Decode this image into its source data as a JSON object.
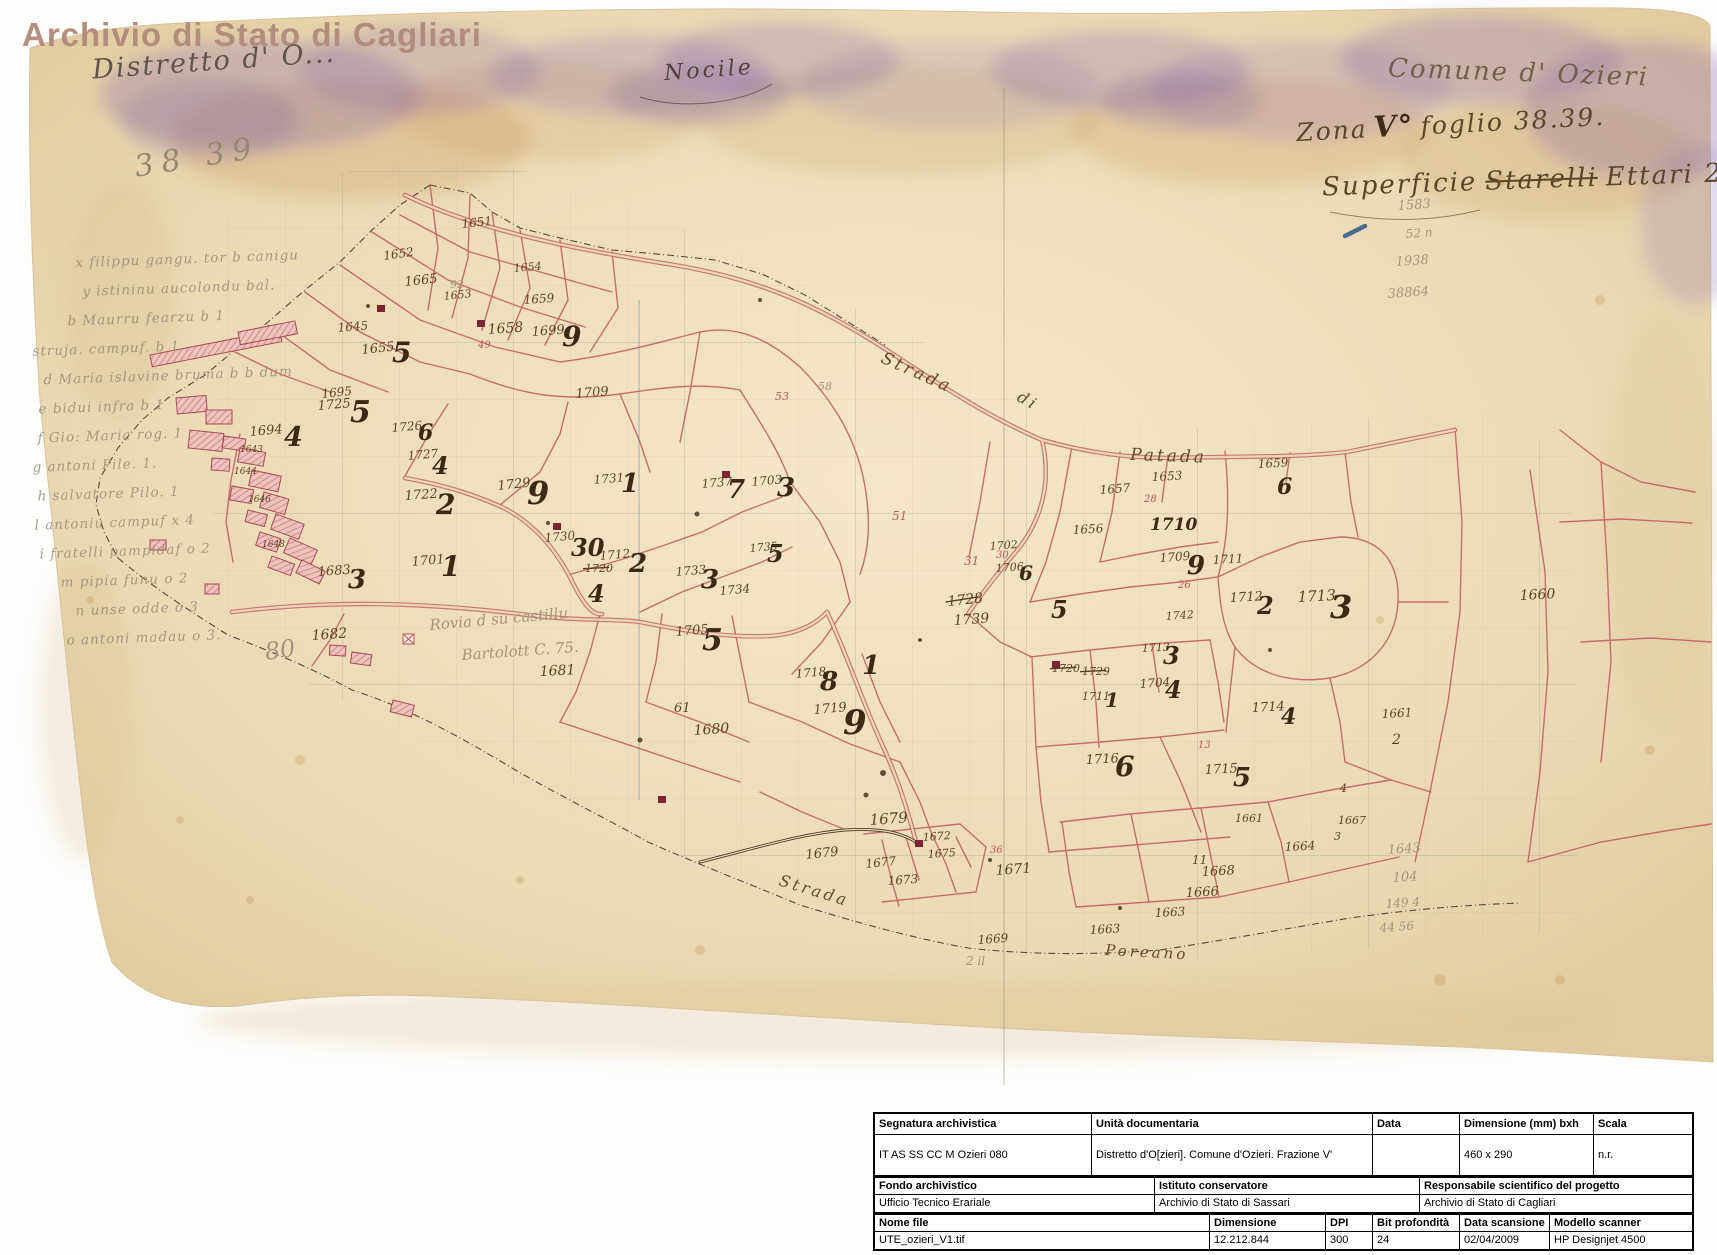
{
  "watermark": "Archivio di Stato di Cagliari",
  "annotations": {
    "distretto": "Distretto d' O...",
    "sheet_pencil": "38 39",
    "center_name": "Nocile",
    "comune": "Comune d' Ozieri",
    "zona_pre": "Zona",
    "zona_v": "V°",
    "zona_post": "foglio 38.39.",
    "superficie_prefix": "Superficie",
    "superficie_struck": "Starelli",
    "superficie_suffix": "Ettari 296,04"
  },
  "margin_notes": [
    {
      "t": "x filippu gangu. tor b canigu",
      "dx": 52
    },
    {
      "t": "y istininu aucolondu bal.",
      "dx": 58
    },
    {
      "t": "b Maurru fearzu b 1",
      "dx": 42
    },
    {
      "t": "struja. campuf. b 1",
      "dx": 6
    },
    {
      "t": "d Maria islavine bruma b b dum",
      "dx": 16
    },
    {
      "t": "e bidui infra b 1",
      "dx": 10
    },
    {
      "t": "f Gio: Maria rog. 1",
      "dx": 8
    },
    {
      "t": "g antoni Pile. 1.",
      "dx": 2
    },
    {
      "t": "h salvatore Pilo. 1",
      "dx": 6
    },
    {
      "t": "l antoniu campuf x 4",
      "dx": 2
    },
    {
      "t": "i fratelli pampidaf o 2",
      "dx": 6
    },
    {
      "t": "m pipia funu o 2",
      "dx": 26
    },
    {
      "t": "n unse odde o 3",
      "dx": 40
    },
    {
      "t": "o antoni madau o 3.",
      "dx": 30
    }
  ],
  "road_labels": [
    {
      "t": "Strada",
      "x": 880,
      "y": 362,
      "s": 17,
      "r": 24
    },
    {
      "t": "di",
      "x": 1016,
      "y": 400,
      "s": 16,
      "r": 30
    },
    {
      "t": "Patada",
      "x": 1130,
      "y": 460,
      "s": 17,
      "r": 2
    },
    {
      "t": "Strada",
      "x": 778,
      "y": 885,
      "s": 16,
      "r": 17
    },
    {
      "t": "Poreano",
      "x": 1105,
      "y": 955,
      "s": 15,
      "r": 3
    }
  ],
  "pencil_scribbles": [
    {
      "t": "Rovia d su castillu",
      "x": 430,
      "y": 630,
      "s": 15,
      "r": -5
    },
    {
      "t": "Bartolott  C. 75.",
      "x": 462,
      "y": 660,
      "s": 15,
      "r": -4
    }
  ],
  "parcel_labels": [
    {
      "t": "1651",
      "x": 462,
      "y": 228,
      "s": 12,
      "c": "i",
      "r": -6
    },
    {
      "t": "1652",
      "x": 384,
      "y": 260,
      "s": 12,
      "c": "i",
      "r": -8
    },
    {
      "t": "1654",
      "x": 514,
      "y": 272,
      "s": 11,
      "c": "i",
      "r": -5
    },
    {
      "t": "1659",
      "x": 524,
      "y": 304,
      "s": 12,
      "c": "i",
      "r": -4
    },
    {
      "t": "1665",
      "x": 405,
      "y": 286,
      "s": 13,
      "c": "i",
      "r": -6
    },
    {
      "t": "92",
      "x": 450,
      "y": 288,
      "s": 11,
      "c": "p"
    },
    {
      "t": "1653",
      "x": 444,
      "y": 300,
      "s": 11,
      "c": "i",
      "r": -6
    },
    {
      "t": "1645",
      "x": 338,
      "y": 332,
      "s": 12,
      "c": "i",
      "r": -5
    },
    {
      "t": "1658",
      "x": 488,
      "y": 334,
      "s": 14,
      "c": "i",
      "r": -4
    },
    {
      "t": "49",
      "x": 478,
      "y": 348,
      "s": 10,
      "c": "r"
    },
    {
      "t": "1699",
      "x": 532,
      "y": 336,
      "s": 13,
      "c": "i",
      "r": -4
    },
    {
      "t": "9",
      "x": 562,
      "y": 346,
      "s": 28,
      "c": "b"
    },
    {
      "t": "1655",
      "x": 362,
      "y": 354,
      "s": 13,
      "c": "i",
      "r": -6
    },
    {
      "t": "5",
      "x": 392,
      "y": 362,
      "s": 28,
      "c": "b"
    },
    {
      "t": "1709",
      "x": 576,
      "y": 398,
      "s": 13,
      "c": "i",
      "r": -5
    },
    {
      "t": "1695",
      "x": 322,
      "y": 398,
      "s": 12,
      "c": "i",
      "r": -6
    },
    {
      "t": "1694",
      "x": 250,
      "y": 436,
      "s": 13,
      "c": "i",
      "r": -5
    },
    {
      "t": "4",
      "x": 284,
      "y": 446,
      "s": 27,
      "c": "b"
    },
    {
      "t": "1725",
      "x": 318,
      "y": 410,
      "s": 13,
      "c": "i",
      "r": -5
    },
    {
      "t": "5",
      "x": 350,
      "y": 422,
      "s": 30,
      "c": "b"
    },
    {
      "t": "1726",
      "x": 392,
      "y": 432,
      "s": 12,
      "c": "i",
      "r": -5
    },
    {
      "t": "6",
      "x": 418,
      "y": 440,
      "s": 22,
      "c": "b"
    },
    {
      "t": "1727",
      "x": 408,
      "y": 460,
      "s": 12,
      "c": "i",
      "r": -5
    },
    {
      "t": "4",
      "x": 432,
      "y": 474,
      "s": 24,
      "c": "b"
    },
    {
      "t": "1722",
      "x": 405,
      "y": 500,
      "s": 13,
      "c": "i",
      "r": -4
    },
    {
      "t": "2",
      "x": 436,
      "y": 514,
      "s": 28,
      "c": "b"
    },
    {
      "t": "1729",
      "x": 498,
      "y": 490,
      "s": 13,
      "c": "i",
      "r": -6
    },
    {
      "t": "9",
      "x": 527,
      "y": 504,
      "s": 32,
      "c": "b"
    },
    {
      "t": "1731",
      "x": 594,
      "y": 484,
      "s": 12,
      "c": "i",
      "r": -5
    },
    {
      "t": "1",
      "x": 621,
      "y": 492,
      "s": 26,
      "c": "b"
    },
    {
      "t": "1737",
      "x": 702,
      "y": 488,
      "s": 12,
      "c": "i",
      "r": -5
    },
    {
      "t": "7",
      "x": 727,
      "y": 498,
      "s": 26,
      "c": "b"
    },
    {
      "t": "1703",
      "x": 752,
      "y": 486,
      "s": 12,
      "c": "i",
      "r": -5
    },
    {
      "t": "3",
      "x": 777,
      "y": 496,
      "s": 26,
      "c": "b"
    },
    {
      "t": "1730",
      "x": 545,
      "y": 542,
      "s": 12,
      "c": "i",
      "r": -5
    },
    {
      "t": "30",
      "x": 571,
      "y": 556,
      "s": 24,
      "c": "b"
    },
    {
      "t": "1712",
      "x": 600,
      "y": 560,
      "s": 12,
      "c": "i",
      "r": -5
    },
    {
      "t": "2",
      "x": 629,
      "y": 572,
      "s": 26,
      "c": "b"
    },
    {
      "t": "1701",
      "x": 412,
      "y": 566,
      "s": 13,
      "c": "i",
      "r": -5
    },
    {
      "t": "1",
      "x": 441,
      "y": 576,
      "s": 28,
      "c": "b"
    },
    {
      "t": "1720",
      "x": 585,
      "y": 572,
      "s": 11,
      "c": "i",
      "k": 1
    },
    {
      "t": "1733",
      "x": 676,
      "y": 576,
      "s": 12,
      "c": "i",
      "r": -5
    },
    {
      "t": "3",
      "x": 701,
      "y": 588,
      "s": 26,
      "c": "b"
    },
    {
      "t": "1734",
      "x": 720,
      "y": 595,
      "s": 12,
      "c": "i",
      "r": -5
    },
    {
      "t": "1735",
      "x": 750,
      "y": 552,
      "s": 11,
      "c": "i",
      "r": -5
    },
    {
      "t": "5",
      "x": 767,
      "y": 562,
      "s": 24,
      "c": "b"
    },
    {
      "t": "1683",
      "x": 318,
      "y": 576,
      "s": 13,
      "c": "i",
      "r": -4
    },
    {
      "t": "3",
      "x": 348,
      "y": 588,
      "s": 26,
      "c": "b"
    },
    {
      "t": "1682",
      "x": 312,
      "y": 640,
      "s": 14,
      "c": "i",
      "r": -4
    },
    {
      "t": "80",
      "x": 266,
      "y": 660,
      "s": 24,
      "c": "p",
      "r": -8
    },
    {
      "t": "1681",
      "x": 540,
      "y": 676,
      "s": 14,
      "c": "i",
      "r": -3
    },
    {
      "t": "4",
      "x": 588,
      "y": 602,
      "s": 24,
      "c": "b"
    },
    {
      "t": "1705",
      "x": 676,
      "y": 636,
      "s": 13,
      "c": "i",
      "r": -5
    },
    {
      "t": "5",
      "x": 702,
      "y": 650,
      "s": 30,
      "c": "b"
    },
    {
      "t": "61",
      "x": 674,
      "y": 712,
      "s": 13,
      "c": "i"
    },
    {
      "t": "1680",
      "x": 694,
      "y": 735,
      "s": 14,
      "c": "i",
      "r": -4
    },
    {
      "t": "1718",
      "x": 796,
      "y": 678,
      "s": 12,
      "c": "i",
      "r": -5
    },
    {
      "t": "8",
      "x": 820,
      "y": 690,
      "s": 26,
      "c": "b"
    },
    {
      "t": "1719",
      "x": 814,
      "y": 714,
      "s": 13,
      "c": "i",
      "r": -5
    },
    {
      "t": "9",
      "x": 843,
      "y": 734,
      "s": 34,
      "c": "b"
    },
    {
      "t": "1",
      "x": 862,
      "y": 674,
      "s": 26,
      "c": "b"
    },
    {
      "t": "1643",
      "x": 240,
      "y": 452,
      "s": 9,
      "c": "i"
    },
    {
      "t": "1644",
      "x": 234,
      "y": 474,
      "s": 9,
      "c": "i"
    },
    {
      "t": "1646",
      "x": 248,
      "y": 502,
      "s": 9,
      "c": "i"
    },
    {
      "t": "1648",
      "x": 262,
      "y": 547,
      "s": 9,
      "c": "i"
    },
    {
      "t": "53",
      "x": 775,
      "y": 400,
      "s": 11,
      "c": "r"
    },
    {
      "t": "58",
      "x": 818,
      "y": 390,
      "s": 11,
      "c": "p"
    },
    {
      "t": "51",
      "x": 892,
      "y": 520,
      "s": 12,
      "c": "r"
    },
    {
      "t": "31",
      "x": 964,
      "y": 565,
      "s": 12,
      "c": "r"
    },
    {
      "t": "1728",
      "x": 948,
      "y": 606,
      "s": 14,
      "c": "i",
      "k": 1,
      "r": -6
    },
    {
      "t": "1739",
      "x": 954,
      "y": 625,
      "s": 14,
      "c": "i",
      "r": -4
    },
    {
      "t": "1679",
      "x": 870,
      "y": 825,
      "s": 15,
      "c": "i",
      "r": -4
    },
    {
      "t": "1679",
      "x": 806,
      "y": 859,
      "s": 13,
      "c": "i",
      "r": -6
    },
    {
      "t": "1677",
      "x": 866,
      "y": 868,
      "s": 12,
      "c": "i",
      "r": -6
    },
    {
      "t": "1673",
      "x": 888,
      "y": 885,
      "s": 12,
      "c": "i",
      "r": -4
    },
    {
      "t": "1675",
      "x": 928,
      "y": 858,
      "s": 11,
      "c": "i",
      "r": -4
    },
    {
      "t": "1672",
      "x": 923,
      "y": 841,
      "s": 11,
      "c": "i",
      "r": -4
    },
    {
      "t": "1671",
      "x": 996,
      "y": 875,
      "s": 14,
      "c": "i",
      "r": -4
    },
    {
      "t": "36",
      "x": 990,
      "y": 853,
      "s": 10,
      "c": "r"
    },
    {
      "t": "1669",
      "x": 978,
      "y": 944,
      "s": 12,
      "c": "i",
      "r": -4
    },
    {
      "t": "2 il",
      "x": 966,
      "y": 965,
      "s": 12,
      "c": "p"
    },
    {
      "t": "1653",
      "x": 1152,
      "y": 481,
      "s": 12,
      "c": "i",
      "r": -3
    },
    {
      "t": "1657",
      "x": 1100,
      "y": 494,
      "s": 12,
      "c": "i",
      "r": -4
    },
    {
      "t": "28",
      "x": 1144,
      "y": 502,
      "s": 10,
      "c": "r"
    },
    {
      "t": "1656",
      "x": 1073,
      "y": 534,
      "s": 12,
      "c": "i",
      "r": -3
    },
    {
      "t": "30",
      "x": 996,
      "y": 558,
      "s": 10,
      "c": "r"
    },
    {
      "t": "1659",
      "x": 1258,
      "y": 468,
      "s": 12,
      "c": "i",
      "r": -3
    },
    {
      "t": "6",
      "x": 1277,
      "y": 494,
      "s": 22,
      "c": "b"
    },
    {
      "t": "1710",
      "x": 1150,
      "y": 530,
      "s": 17,
      "c": "b"
    },
    {
      "t": "1709",
      "x": 1160,
      "y": 562,
      "s": 12,
      "c": "i",
      "r": -4
    },
    {
      "t": "9",
      "x": 1187,
      "y": 574,
      "s": 26,
      "c": "b"
    },
    {
      "t": "26",
      "x": 1178,
      "y": 588,
      "s": 10,
      "c": "r"
    },
    {
      "t": "1702",
      "x": 990,
      "y": 550,
      "s": 11,
      "c": "i",
      "r": -4
    },
    {
      "t": "1706",
      "x": 996,
      "y": 572,
      "s": 11,
      "c": "i",
      "r": -4
    },
    {
      "t": "6",
      "x": 1019,
      "y": 580,
      "s": 20,
      "c": "b"
    },
    {
      "t": "5",
      "x": 1051,
      "y": 618,
      "s": 24,
      "c": "b"
    },
    {
      "t": "1711",
      "x": 1213,
      "y": 564,
      "s": 12,
      "c": "i",
      "r": -3
    },
    {
      "t": "1712",
      "x": 1230,
      "y": 602,
      "s": 13,
      "c": "i",
      "r": -3
    },
    {
      "t": "2",
      "x": 1257,
      "y": 614,
      "s": 24,
      "c": "b"
    },
    {
      "t": "1713",
      "x": 1298,
      "y": 602,
      "s": 15,
      "c": "i",
      "r": -3
    },
    {
      "t": "3",
      "x": 1330,
      "y": 618,
      "s": 32,
      "c": "b"
    },
    {
      "t": "1660",
      "x": 1520,
      "y": 600,
      "s": 14,
      "c": "i",
      "r": -3
    },
    {
      "t": "1742",
      "x": 1166,
      "y": 620,
      "s": 11,
      "c": "i",
      "r": -4
    },
    {
      "t": "1713",
      "x": 1142,
      "y": 652,
      "s": 11,
      "c": "i",
      "r": -3
    },
    {
      "t": "3",
      "x": 1163,
      "y": 664,
      "s": 24,
      "c": "b"
    },
    {
      "t": "1704",
      "x": 1140,
      "y": 688,
      "s": 12,
      "c": "i",
      "r": -4
    },
    {
      "t": "4",
      "x": 1165,
      "y": 698,
      "s": 24,
      "c": "b"
    },
    {
      "t": "1714",
      "x": 1252,
      "y": 712,
      "s": 13,
      "c": "i",
      "r": -3
    },
    {
      "t": "4",
      "x": 1281,
      "y": 724,
      "s": 22,
      "c": "b"
    },
    {
      "t": "1720",
      "x": 1052,
      "y": 672,
      "s": 11,
      "c": "i",
      "k": 1
    },
    {
      "t": "1729",
      "x": 1082,
      "y": 675,
      "s": 11,
      "c": "i",
      "k": 1
    },
    {
      "t": "1711",
      "x": 1082,
      "y": 700,
      "s": 11,
      "c": "i"
    },
    {
      "t": "1",
      "x": 1105,
      "y": 707,
      "s": 20,
      "c": "b"
    },
    {
      "t": "1716",
      "x": 1086,
      "y": 764,
      "s": 13,
      "c": "i",
      "r": -3
    },
    {
      "t": "6",
      "x": 1115,
      "y": 776,
      "s": 28,
      "c": "b"
    },
    {
      "t": "1715",
      "x": 1205,
      "y": 774,
      "s": 13,
      "c": "i",
      "r": -3
    },
    {
      "t": "5",
      "x": 1233,
      "y": 786,
      "s": 26,
      "c": "b"
    },
    {
      "t": "1661",
      "x": 1382,
      "y": 718,
      "s": 12,
      "c": "i",
      "r": -3
    },
    {
      "t": "2",
      "x": 1392,
      "y": 744,
      "s": 14,
      "c": "i"
    },
    {
      "t": "4",
      "x": 1340,
      "y": 792,
      "s": 11,
      "c": "i"
    },
    {
      "t": "13",
      "x": 1198,
      "y": 748,
      "s": 10,
      "c": "r"
    },
    {
      "t": "1664",
      "x": 1285,
      "y": 851,
      "s": 12,
      "c": "i",
      "r": -3
    },
    {
      "t": "11",
      "x": 1192,
      "y": 864,
      "s": 12,
      "c": "i"
    },
    {
      "t": "1668",
      "x": 1202,
      "y": 876,
      "s": 13,
      "c": "i",
      "r": -3
    },
    {
      "t": "1666",
      "x": 1186,
      "y": 897,
      "s": 13,
      "c": "i",
      "r": -3
    },
    {
      "t": "1663",
      "x": 1155,
      "y": 917,
      "s": 12,
      "c": "i",
      "r": -3
    },
    {
      "t": "1663",
      "x": 1090,
      "y": 934,
      "s": 12,
      "c": "i",
      "r": -3
    },
    {
      "t": "1661",
      "x": 1235,
      "y": 822,
      "s": 11,
      "c": "i"
    },
    {
      "t": "1667",
      "x": 1338,
      "y": 824,
      "s": 11,
      "c": "i"
    },
    {
      "t": "3",
      "x": 1334,
      "y": 840,
      "s": 11,
      "c": "i"
    },
    {
      "t": "1583",
      "x": 1398,
      "y": 210,
      "s": 13,
      "c": "p",
      "r": -4
    },
    {
      "t": "52 n",
      "x": 1406,
      "y": 238,
      "s": 12,
      "c": "p",
      "r": -4
    },
    {
      "t": "1938",
      "x": 1396,
      "y": 266,
      "s": 13,
      "c": "p",
      "r": -4
    },
    {
      "t": "38864",
      "x": 1388,
      "y": 298,
      "s": 13,
      "c": "p",
      "r": -4
    },
    {
      "t": "1643",
      "x": 1388,
      "y": 854,
      "s": 13,
      "c": "p",
      "r": -4
    },
    {
      "t": "104",
      "x": 1393,
      "y": 882,
      "s": 13,
      "c": "p",
      "r": -4
    },
    {
      "t": "149 4",
      "x": 1386,
      "y": 908,
      "s": 12,
      "c": "p",
      "r": -4
    },
    {
      "t": "44 56",
      "x": 1380,
      "y": 932,
      "s": 12,
      "c": "p",
      "r": -4
    }
  ],
  "table": {
    "sections": [
      {
        "headers": [
          "Segnatura archivistica",
          "Unità documentaria",
          "Data",
          "Dimensione (mm) bxh",
          "Scala"
        ],
        "values": [
          "IT AS SS CC M Ozieri 080",
          "Distretto d'O[zieri]. Comune d'Ozieri. Frazione V'",
          "",
          "460 x 290",
          "n.r."
        ]
      },
      {
        "headers": [
          "Fondo archivistico",
          "Istituto conservatore",
          "Responsabile scientifico del progetto"
        ],
        "values": [
          "Ufficio Tecnico Erariale",
          "Archivio di Stato di Sassari",
          "Archivio di Stato di Cagliari"
        ]
      },
      {
        "headers": [
          "Nome file",
          "Dimensione",
          "DPI",
          "Bit profondità",
          "Data scansione",
          "Modello scanner"
        ],
        "values": [
          "UTE_ozieri_V1.tif",
          "12.212.844",
          "300",
          "24",
          "02/04/2009",
          "HP Designjet 4500"
        ]
      }
    ]
  },
  "colors": {
    "paper": "#ecd9b4",
    "parcel_line": "#bf545c",
    "road_line": "#c2666c",
    "ink": "#5f4323",
    "pencil": "#9b8e78",
    "stain_purple": "#8a68a8",
    "watermark": "#b0897a"
  }
}
